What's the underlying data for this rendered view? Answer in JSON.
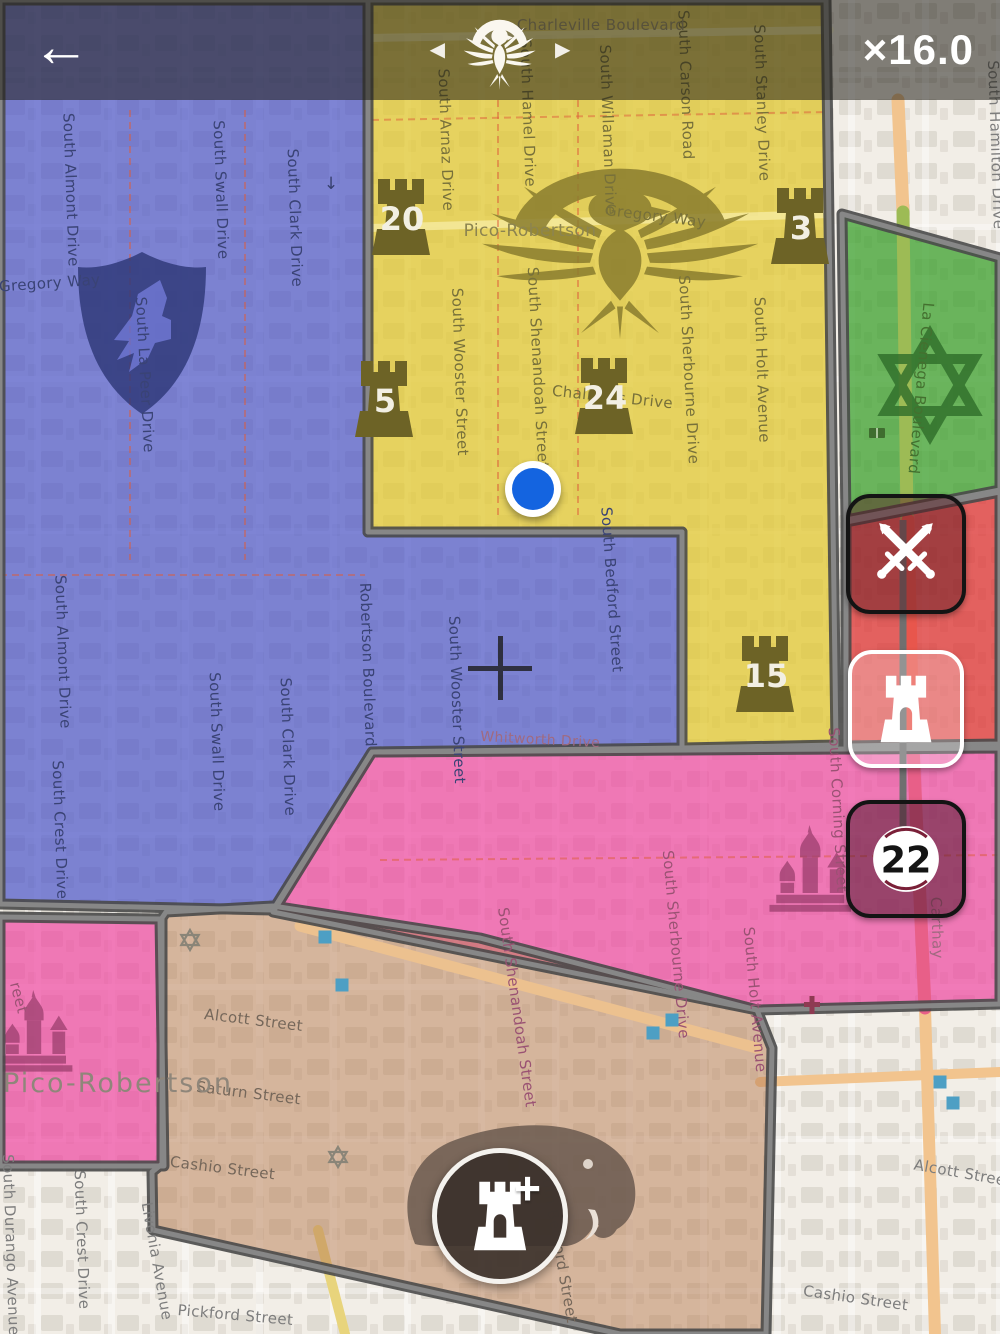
{
  "hud": {
    "back_icon": "←",
    "zoom_label": "×16.0",
    "faction_switcher": {
      "prev_icon": "◀",
      "next_icon": "▶",
      "emblem": "phoenix"
    }
  },
  "side_buttons": {
    "attack": {
      "icon": "crossed-swords"
    },
    "defend": {
      "icon": "tower"
    },
    "medal": {
      "count": "22"
    }
  },
  "build_button": {
    "icon": "tower-plus",
    "plus_icon": "+"
  },
  "towers": {
    "color": "#6d6326",
    "number_color": "#f2efe3",
    "items": [
      {
        "count": "20",
        "x": 402,
        "y": 218
      },
      {
        "count": "3",
        "x": 801,
        "y": 227
      },
      {
        "count": "5",
        "x": 385,
        "y": 400
      },
      {
        "count": "24",
        "x": 605,
        "y": 397
      },
      {
        "count": "15",
        "x": 766,
        "y": 675
      }
    ]
  },
  "territories": {
    "blue": {
      "faction_emblem": "wolf-shield",
      "fill": "rgba(74,84,200,0.70)",
      "emblem_color": "#2e3878"
    },
    "yellow": {
      "faction_emblem": "phoenix",
      "fill": "rgba(226,200,50,0.75)",
      "emblem_color": "#8a7d2e"
    },
    "green": {
      "faction_emblem": "hex-star",
      "fill": "rgba(60,160,45,0.75)",
      "emblem_color": "#2f6d2a"
    },
    "red": {
      "fill": "rgba(222,50,50,0.75)"
    },
    "pink": {
      "faction_emblem": "cathedral",
      "fill": "rgba(238,70,160,0.70)",
      "emblem_color": "#9c3f6e"
    },
    "tan": {
      "faction_emblem": "elephant",
      "fill": "rgba(186,128,88,0.52)",
      "emblem_color": "#6a594f"
    }
  },
  "map": {
    "dot_color": "#1464e0",
    "labels": [
      {
        "t": "South Almont Drive",
        "x": 66,
        "y": 190,
        "r": 88,
        "c": "#3a4375"
      },
      {
        "t": "South Swall Drive",
        "x": 216,
        "y": 190,
        "r": 88,
        "c": "#3a4375"
      },
      {
        "t": "South Clark Drive",
        "x": 290,
        "y": 218,
        "r": 88,
        "c": "#3a4375"
      },
      {
        "t": "Gregory Way",
        "x": 50,
        "y": 288,
        "r": -4,
        "c": "#3a4375"
      },
      {
        "t": "South La Peer Drive",
        "x": 140,
        "y": 375,
        "r": 87,
        "c": "#3a4375"
      },
      {
        "t": "South Almont Drive",
        "x": 58,
        "y": 652,
        "r": 88,
        "c": "#3a4375"
      },
      {
        "t": "South Swall Drive",
        "x": 212,
        "y": 742,
        "r": 88,
        "c": "#3a4375"
      },
      {
        "t": "South Clark Drive",
        "x": 283,
        "y": 747,
        "r": 88,
        "c": "#3a4375"
      },
      {
        "t": "Robertson Boulevard",
        "x": 363,
        "y": 665,
        "r": 88,
        "c": "#3a4375"
      },
      {
        "t": "South Crest Drive",
        "x": 55,
        "y": 830,
        "r": 88,
        "c": "#3a4375"
      },
      {
        "t": "South Wooster Street",
        "x": 452,
        "y": 700,
        "r": 88,
        "c": "#3a4375"
      },
      {
        "t": "South Bedford Street",
        "x": 607,
        "y": 590,
        "r": 86,
        "c": "#3a4375"
      },
      {
        "t": "South Wooster Street",
        "x": 455,
        "y": 372,
        "r": 88,
        "c": "#77703a"
      },
      {
        "t": "South Shenandoah Street",
        "x": 533,
        "y": 368,
        "r": 87,
        "c": "#77703a"
      },
      {
        "t": "Pico-Robertson",
        "x": 530,
        "y": 236,
        "r": 0,
        "c": "#8c8450",
        "s": 17
      },
      {
        "t": "Gregory Way",
        "x": 655,
        "y": 221,
        "r": 7,
        "c": "#77703a"
      },
      {
        "t": "Chalmers Drive",
        "x": 612,
        "y": 402,
        "r": 6,
        "c": "#77703a"
      },
      {
        "t": "South Arnaz Drive",
        "x": 441,
        "y": 140,
        "r": 88,
        "c": "#77703a"
      },
      {
        "t": "South Hamel Drive",
        "x": 523,
        "y": 113,
        "r": 88,
        "c": "#77703a"
      },
      {
        "t": "South Willaman Drive",
        "x": 603,
        "y": 130,
        "r": 88,
        "c": "#77703a"
      },
      {
        "t": "South Carson Road",
        "x": 681,
        "y": 85,
        "r": 88,
        "c": "#77703a"
      },
      {
        "t": "South Stanley Drive",
        "x": 757,
        "y": 103,
        "r": 88,
        "c": "#77703a"
      },
      {
        "t": "Charleville Boulevard",
        "x": 601,
        "y": 30,
        "r": 0,
        "c": "#9a8f66"
      },
      {
        "t": "South Sherbourne Drive",
        "x": 684,
        "y": 370,
        "r": 87,
        "c": "#77703a"
      },
      {
        "t": "South Holt Avenue",
        "x": 757,
        "y": 370,
        "r": 88,
        "c": "#77703a"
      },
      {
        "t": "La Cienega Boulevard",
        "x": 916,
        "y": 388,
        "r": 95,
        "c": "#44702f"
      },
      {
        "t": "South Hamilton Drive",
        "x": 991,
        "y": 145,
        "r": 88,
        "c": "#7d7d7d"
      },
      {
        "t": "Whitworth Drive",
        "x": 540,
        "y": 744,
        "r": 3,
        "c": "#a06a80",
        "s": 14
      },
      {
        "t": "South Corning Street",
        "x": 833,
        "y": 810,
        "r": 87,
        "c": "#9a5273"
      },
      {
        "t": "Carthay",
        "x": 932,
        "y": 928,
        "r": 88,
        "c": "#a06a80"
      },
      {
        "t": "South Sherbourne Drive",
        "x": 671,
        "y": 945,
        "r": 85,
        "c": "#9a5273"
      },
      {
        "t": "South Holt Avenue",
        "x": 750,
        "y": 1000,
        "r": 85,
        "c": "#9a5273"
      },
      {
        "t": "South Shenandoah Street",
        "x": 512,
        "y": 1008,
        "r": 82,
        "c": "#9a5273"
      },
      {
        "t": "reet",
        "x": 14,
        "y": 999,
        "r": 75,
        "c": "#9a5273"
      },
      {
        "t": "Alcott Street",
        "x": 253,
        "y": 1025,
        "r": 7,
        "c": "#75675a"
      },
      {
        "t": "Saturn Street",
        "x": 248,
        "y": 1098,
        "r": 7,
        "c": "#75675a"
      },
      {
        "t": "Cashio Street",
        "x": 222,
        "y": 1173,
        "r": 7,
        "c": "#75675a"
      },
      {
        "t": "Pico-Robertson",
        "x": 118,
        "y": 1092,
        "r": 0,
        "c": "#8f867a",
        "s": 27,
        "ls": 2
      },
      {
        "t": "South Bedford Street",
        "x": 553,
        "y": 1242,
        "r": 80,
        "c": "#75675a"
      },
      {
        "t": "South Durango Avenue",
        "x": 6,
        "y": 1245,
        "r": 88,
        "c": "#7d7d7d"
      },
      {
        "t": "South Crest Drive",
        "x": 77,
        "y": 1240,
        "r": 88,
        "c": "#7d7d7d"
      },
      {
        "t": "Livonia Avenue",
        "x": 152,
        "y": 1262,
        "r": 80,
        "c": "#7d7d7d"
      },
      {
        "t": "Pickford Street",
        "x": 235,
        "y": 1320,
        "r": 5,
        "c": "#7d7d7d"
      },
      {
        "t": "Cashio Street",
        "x": 855,
        "y": 1303,
        "r": 8,
        "c": "#7d7d7d"
      },
      {
        "t": "Alcott Street",
        "x": 962,
        "y": 1178,
        "r": 10,
        "c": "#7d7d7d"
      }
    ],
    "pois": [
      {
        "type": "square",
        "x": 325,
        "y": 937
      },
      {
        "type": "square",
        "x": 342,
        "y": 985
      },
      {
        "type": "square",
        "x": 672,
        "y": 1020
      },
      {
        "type": "square",
        "x": 653,
        "y": 1033
      },
      {
        "type": "square",
        "x": 940,
        "y": 1082
      },
      {
        "type": "square",
        "x": 953,
        "y": 1103
      },
      {
        "type": "star",
        "x": 190,
        "y": 940
      },
      {
        "type": "star",
        "x": 338,
        "y": 1157
      },
      {
        "type": "cross",
        "x": 812,
        "y": 1005
      },
      {
        "type": "arrow",
        "x": 331,
        "y": 183
      },
      {
        "type": "book",
        "x": 877,
        "y": 433
      }
    ]
  }
}
